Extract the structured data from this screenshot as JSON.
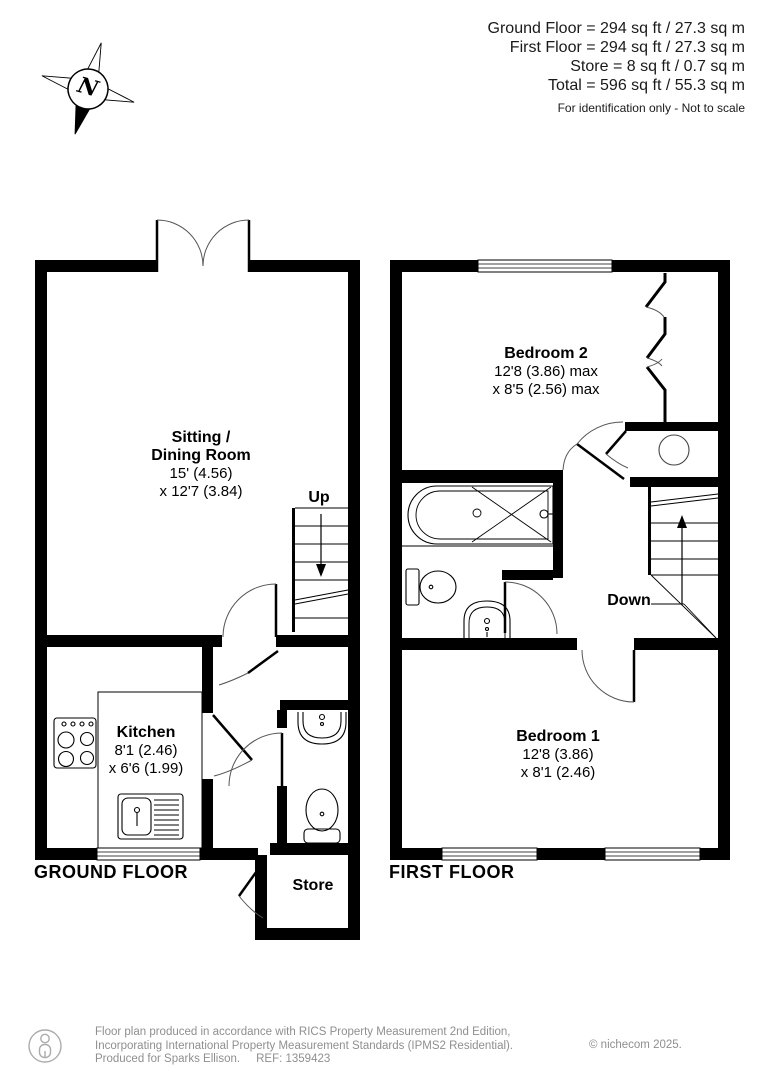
{
  "header": {
    "areas": [
      "Ground Floor = 294 sq ft / 27.3 sq m",
      "First Floor = 294 sq ft / 27.3 sq m",
      "Store = 8 sq ft / 0.7 sq m",
      "Total = 596 sq ft / 55.3 sq m"
    ],
    "disclaimer": "For identification only - Not to scale"
  },
  "compass": {
    "north_label": "N"
  },
  "ground_floor": {
    "title": "GROUND FLOOR",
    "stairs_label": "Up",
    "rooms": {
      "sitting_dining": {
        "name1": "Sitting /",
        "name2": "Dining Room",
        "dim1": "15' (4.56)",
        "dim2": "x 12'7 (3.84)"
      },
      "kitchen": {
        "name": "Kitchen",
        "dim1": "8'1 (2.46)",
        "dim2": "x 6'6 (1.99)"
      },
      "store": {
        "name": "Store"
      }
    }
  },
  "first_floor": {
    "title": "FIRST FLOOR",
    "stairs_label": "Down",
    "rooms": {
      "bedroom2": {
        "name": "Bedroom 2",
        "dim1": "12'8 (3.86) max",
        "dim2": "x 8'5 (2.56) max"
      },
      "bedroom1": {
        "name": "Bedroom 1",
        "dim1": "12'8 (3.86)",
        "dim2": "x 8'1 (2.46)"
      }
    }
  },
  "footer": {
    "line1": "Floor plan produced in accordance with RICS Property Measurement 2nd Edition,",
    "line2": "Incorporating International Property Measurement Standards (IPMS2 Residential).",
    "line3_prefix": "Produced for Sparks Ellison.",
    "ref": "REF: 1359423",
    "copyright": "© nichecom 2025."
  },
  "colors": {
    "wall": "#000000",
    "text": "#1a1a1a",
    "footer_text": "#8f8f8f"
  }
}
